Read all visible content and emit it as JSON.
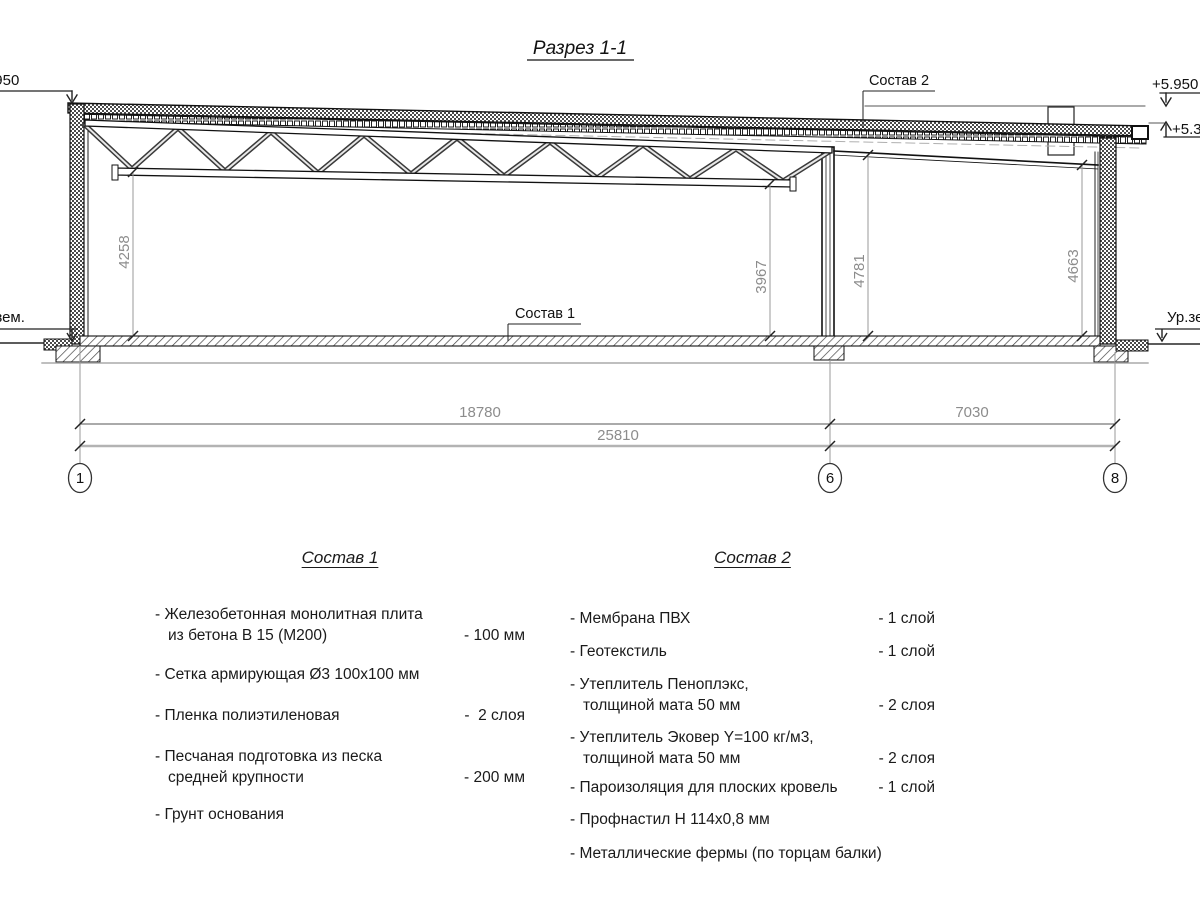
{
  "title": "Разрез 1-1",
  "marks": {
    "elev_left": "+5.950",
    "elev_right_top": "+5.950",
    "elev_right_mid": "+5.380",
    "ground_left": "Ур.зем.",
    "ground_right": "Ур.зем.",
    "sostav1_label": "Состав 1",
    "sostav2_label": "Состав 2"
  },
  "dims": {
    "v1": "4258",
    "v2": "3967",
    "v3": "4781",
    "v4": "4663",
    "h1": "18780",
    "h2": "7030",
    "total": "25810"
  },
  "axes": {
    "a1": "1",
    "a6": "6",
    "a8": "8"
  },
  "sostav1": {
    "title": "Состав 1",
    "items": [
      {
        "name": "- Железобетонная  монолитная плита\nиз бетона В 15 (М200)",
        "value": "- 100 мм"
      },
      {
        "name": "- Сетка армирующая Ø3 100х100 мм",
        "value": ""
      },
      {
        "name": "- Пленка полиэтиленовая",
        "value": "-  2 слоя"
      },
      {
        "name": "- Песчаная подготовка из песка\nсредней крупности",
        "value": "- 200 мм"
      },
      {
        "name": "- Грунт основания",
        "value": ""
      }
    ]
  },
  "sostav2": {
    "title": "Состав 2",
    "items": [
      {
        "name": "- Мембрана ПВХ",
        "value": "- 1 слой"
      },
      {
        "name": "- Геотекстиль",
        "value": "- 1 слой"
      },
      {
        "name": "- Утеплитель Пеноплэкс,\nтолщиной мата 50 мм",
        "value": "- 2 слоя"
      },
      {
        "name": "- Утеплитель Эковер Y=100 кг/м3,\nтолщиной мата 50 мм",
        "value": "- 2 слоя"
      },
      {
        "name": "- Пароизоляция для плоских кровель",
        "value": "- 1 слой"
      },
      {
        "name": "- Профнастил Н 114х0,8 мм",
        "value": ""
      },
      {
        "name": "- Металлические фермы (по торцам балки)",
        "value": ""
      }
    ]
  }
}
